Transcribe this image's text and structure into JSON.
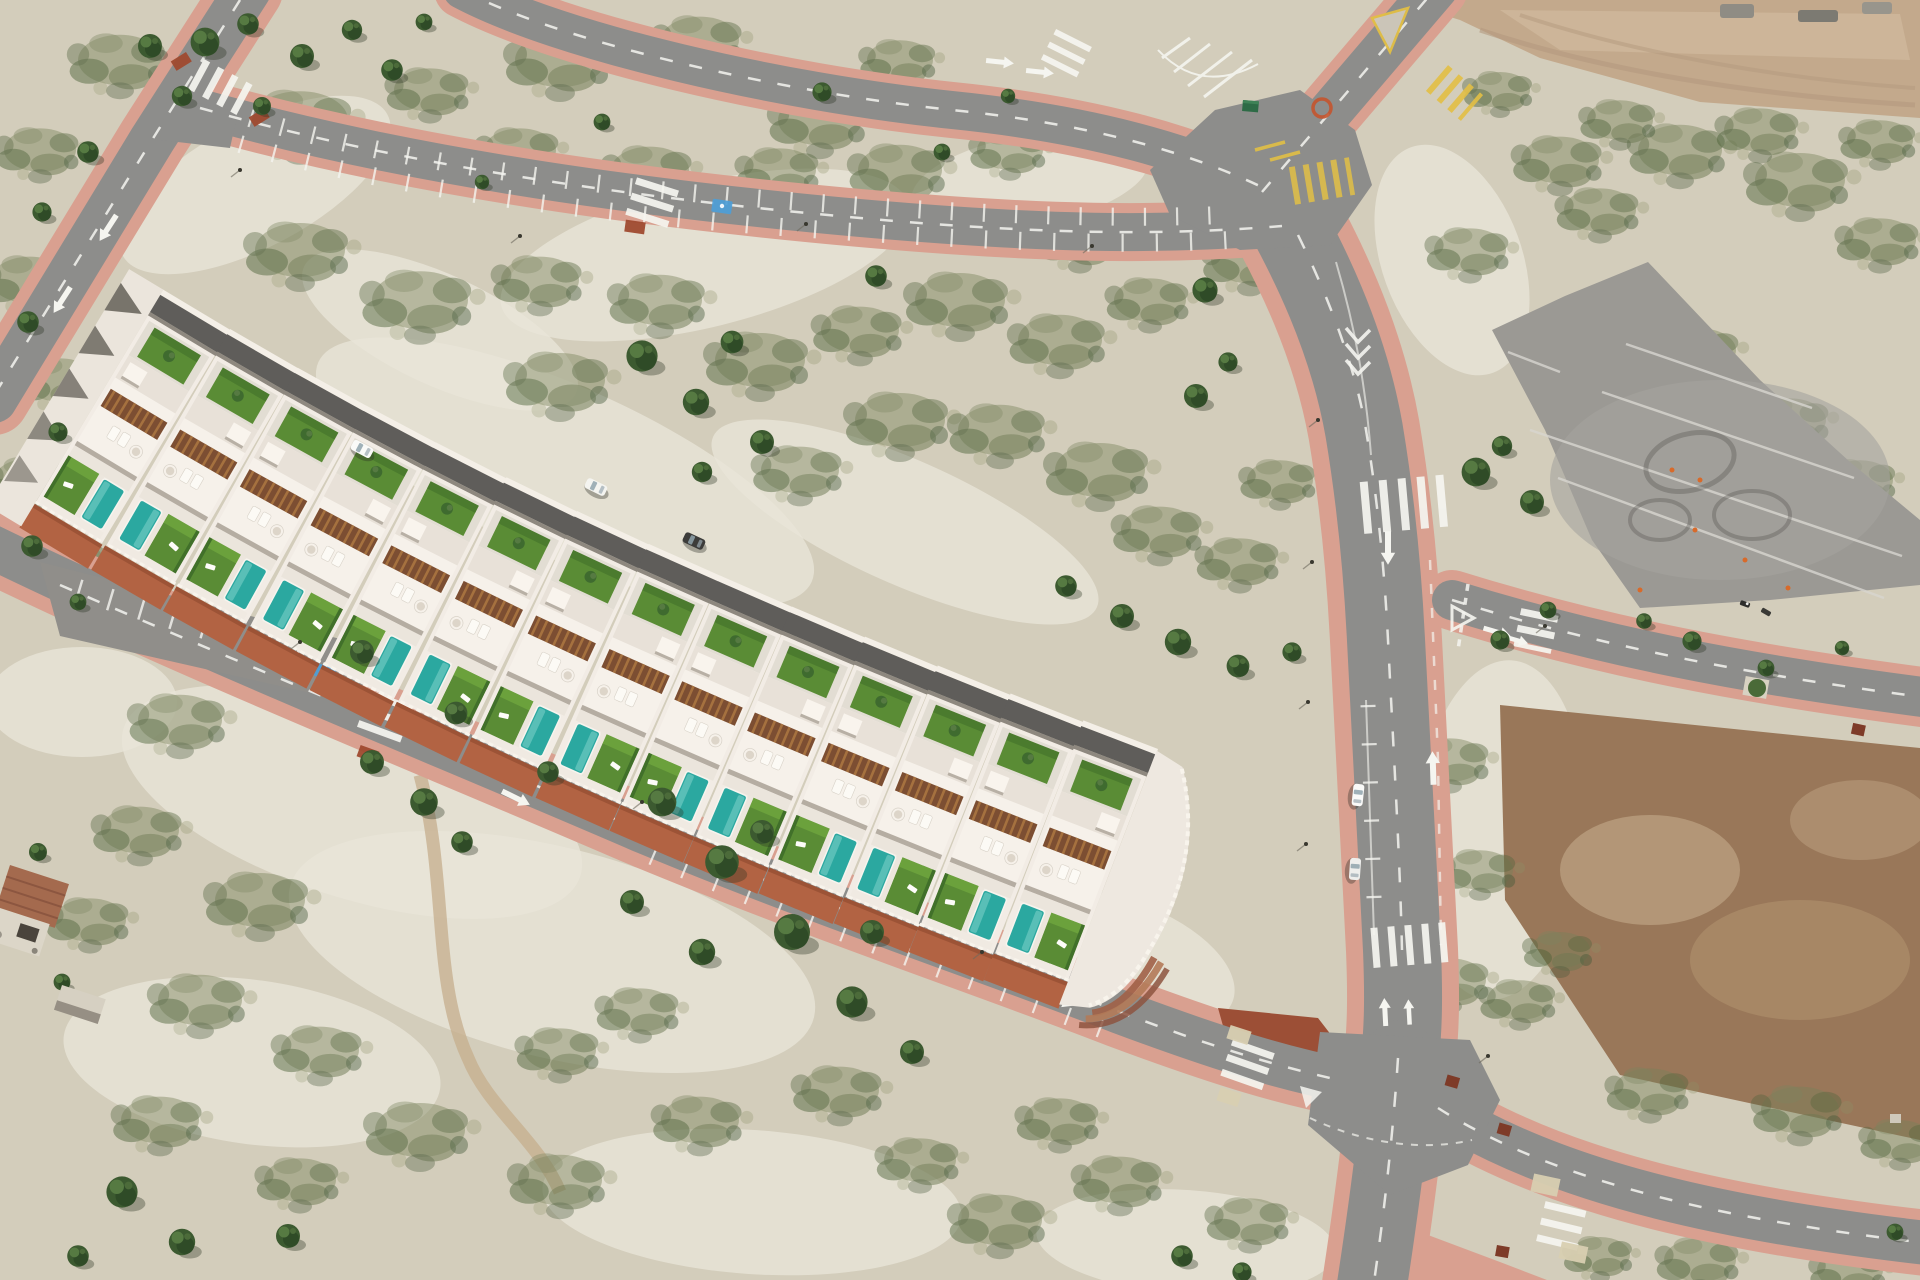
{
  "meta": {
    "type": "aerial-drone-photograph",
    "subject": "New-build terraced villa development with private pools beside an urbanised road network on semi-arid scrubland",
    "width_px": 1920,
    "height_px": 1280
  },
  "palette": {
    "ground_base": "#cfc9b4",
    "chalk": "#e9e5d8",
    "scrub_olive": "#77815a",
    "scrub_dark": "#4c6339",
    "pine_green": "#3c5a30",
    "asphalt": "#8d8d8b",
    "asphalt_light": "#9b9994",
    "sidewalk_pink": "#d9a090",
    "sidewalk_brick_red": "#b26343",
    "paver_dark_red": "#9c4f36",
    "dirt_tan": "#c3a98c",
    "dirt_brown": "#997759",
    "marking_white": "#f5f5f0",
    "marking_yellow": "#e2bf45",
    "villa_white": "#f2ece5",
    "pergola_brown": "#7c4e32",
    "lawn_green": "#5a8c35",
    "pool_turquoise": "#2ba8a0",
    "alley_asphalt": "#5f5d5a",
    "disabled_bay_blue": "#4d9fd8",
    "cone_orange": "#d86a2a",
    "terracotta_roof": "#a46a4e",
    "container_green": "#2e6b46"
  },
  "scene": {
    "development": {
      "name": "villa-row",
      "unit_count": 14,
      "unit_spacing_px": 78,
      "per_unit_features": [
        "rooftop solarium with sun loungers",
        "timber pergola",
        "rear patio lawn with palm",
        "front lawn",
        "private turquoise pool",
        "rear service alley access"
      ],
      "units": [
        [
          150,
          312,
          31
        ],
        [
          218,
          352,
          30
        ],
        [
          286,
          391,
          29
        ],
        [
          355,
          429,
          28
        ],
        [
          425,
          466,
          27
        ],
        [
          496,
          501,
          26
        ],
        [
          567,
          535,
          25
        ],
        [
          639,
          568,
          24
        ],
        [
          711,
          600,
          23.5
        ],
        [
          783,
          631,
          23
        ],
        [
          856,
          661,
          22.5
        ],
        [
          929,
          690,
          22
        ],
        [
          1002,
          718,
          21.5
        ],
        [
          1075,
          745,
          21
        ]
      ]
    },
    "vehicles": {
      "cars": [
        {
          "x": 1358,
          "y": 795,
          "rot": 96,
          "body": "#fafaf8",
          "note": "parked on main avenue"
        },
        {
          "x": 1355,
          "y": 869,
          "rot": 94,
          "body": "#eeeeec",
          "note": "parked on main avenue"
        },
        {
          "x": 362,
          "y": 449,
          "rot": 28,
          "body": "#fafaf8",
          "note": "rear alley of villas"
        },
        {
          "x": 596,
          "y": 487,
          "rot": 26,
          "body": "#f4f4f0",
          "note": "rear alley of villas"
        },
        {
          "x": 694,
          "y": 541,
          "rot": 25,
          "body": "#3c3c3a",
          "note": "dark SUV in rear alley"
        }
      ],
      "motorbikes": [
        {
          "x": 1745,
          "y": 604
        },
        {
          "x": 1766,
          "y": 612
        }
      ]
    },
    "roads": [
      {
        "name": "top-left-avenue",
        "features": [
          "zebra crossing",
          "lane arrows",
          "pink sidewalks"
        ]
      },
      {
        "name": "parking-street",
        "features": [
          "marked parking bays both sides",
          "zebra crossing",
          "blue disabled bay",
          "red paved bulb"
        ]
      },
      {
        "name": "upper-connector",
        "features": [
          "zebra crossing",
          "white chevron island",
          "direction arrows"
        ]
      },
      {
        "name": "north-exit",
        "features": [
          "yellow temporary markings",
          "splitter island",
          "yellow zebra"
        ]
      },
      {
        "name": "main-avenue",
        "features": [
          "two zebra crossings",
          "down and up lane arrows",
          "merge chevrons",
          "dashed lane lines",
          "parking ticks",
          "two parked cars"
        ]
      },
      {
        "name": "east-branch",
        "features": [
          "give-way triangle",
          "turn arrows",
          "zebra crossing",
          "stop dashes",
          "tree pit"
        ]
      },
      {
        "name": "villa-street",
        "features": [
          "parking apron with bays",
          "blue disabled bay",
          "zebra crossing",
          "direction arrows",
          "brick-red upper sidewalk"
        ]
      },
      {
        "name": "southeast-road",
        "features": [
          "zebra crossing",
          "tactile paving pads",
          "dashed centre line",
          "dark-red tree pits"
        ]
      }
    ],
    "terrain": {
      "dirt_lot_top_right": "graded bare earth with spoil heaps",
      "dirt_lot_mid_right": "brown cleared building plot",
      "practice_area": "asphalt pad with painted guide lines, circular skid marks, traffic cones and two motorbikes",
      "chalk": [
        [
          255,
          185,
          150,
          62,
          -28
        ],
        [
          705,
          255,
          210,
          72,
          -14
        ],
        [
          565,
          472,
          270,
          85,
          24
        ],
        [
          905,
          522,
          210,
          62,
          24
        ],
        [
          352,
          802,
          240,
          95,
          18
        ],
        [
          552,
          952,
          270,
          105,
          14
        ],
        [
          252,
          1062,
          190,
          82,
          8
        ],
        [
          752,
          1202,
          210,
          72,
          4
        ],
        [
          1500,
          830,
          85,
          170,
          4
        ],
        [
          1186,
          1242,
          150,
          52,
          4
        ],
        [
          82,
          702,
          95,
          55,
          0
        ],
        [
          1452,
          260,
          70,
          120,
          -20
        ],
        [
          1030,
          180,
          120,
          45,
          -10
        ],
        [
          440,
          330,
          150,
          55,
          25
        ],
        [
          1120,
          960,
          120,
          60,
          20
        ]
      ]
    },
    "vegetation": {
      "pines": [
        [
          205,
          42,
          1.2
        ],
        [
          248,
          24,
          0.9
        ],
        [
          302,
          56,
          1.0
        ],
        [
          352,
          30,
          0.85
        ],
        [
          392,
          70,
          0.9
        ],
        [
          424,
          22,
          0.7
        ],
        [
          182,
          96,
          0.85
        ],
        [
          262,
          106,
          0.75
        ],
        [
          88,
          152,
          0.9
        ],
        [
          42,
          212,
          0.8
        ],
        [
          28,
          322,
          0.9
        ],
        [
          58,
          432,
          0.8
        ],
        [
          32,
          546,
          0.9
        ],
        [
          78,
          602,
          0.7
        ],
        [
          150,
          46,
          1.0
        ],
        [
          642,
          356,
          1.3
        ],
        [
          696,
          402,
          1.1
        ],
        [
          732,
          342,
          0.95
        ],
        [
          762,
          442,
          1.0
        ],
        [
          702,
          472,
          0.85
        ],
        [
          876,
          276,
          0.9
        ],
        [
          942,
          152,
          0.7
        ],
        [
          822,
          92,
          0.8
        ],
        [
          602,
          122,
          0.7
        ],
        [
          482,
          182,
          0.6
        ],
        [
          1008,
          96,
          0.6
        ],
        [
          1066,
          586,
          0.9
        ],
        [
          1122,
          616,
          1.0
        ],
        [
          1178,
          642,
          1.1
        ],
        [
          1238,
          666,
          0.95
        ],
        [
          1292,
          652,
          0.8
        ],
        [
          1196,
          396,
          1.0
        ],
        [
          1228,
          362,
          0.8
        ],
        [
          1205,
          290,
          1.05
        ],
        [
          1476,
          472,
          1.2
        ],
        [
          1532,
          502,
          1.0
        ],
        [
          1502,
          446,
          0.85
        ],
        [
          1692,
          641,
          0.8
        ],
        [
          1766,
          668,
          0.7
        ],
        [
          1644,
          621,
          0.65
        ],
        [
          1842,
          648,
          0.6
        ],
        [
          122,
          1192,
          1.3
        ],
        [
          182,
          1242,
          1.1
        ],
        [
          78,
          1256,
          0.9
        ],
        [
          288,
          1236,
          1.0
        ],
        [
          62,
          982,
          0.7
        ],
        [
          38,
          852,
          0.75
        ],
        [
          662,
          802,
          1.2
        ],
        [
          722,
          862,
          1.4
        ],
        [
          792,
          932,
          1.5
        ],
        [
          852,
          1002,
          1.3
        ],
        [
          702,
          952,
          1.1
        ],
        [
          632,
          902,
          1.0
        ],
        [
          762,
          832,
          1.0
        ],
        [
          872,
          932,
          1.0
        ],
        [
          424,
          802,
          1.15
        ],
        [
          372,
          762,
          1.0
        ],
        [
          462,
          842,
          0.9
        ],
        [
          912,
          1052,
          1.0
        ],
        [
          362,
          652,
          1.0
        ],
        [
          456,
          713,
          0.95
        ],
        [
          548,
          772,
          0.9
        ],
        [
          1182,
          1256,
          0.9
        ],
        [
          1242,
          1272,
          0.8
        ],
        [
          1895,
          1232,
          0.7
        ],
        [
          1500,
          640,
          0.8
        ],
        [
          1548,
          610,
          0.7
        ]
      ],
      "scrub": [
        [
          120,
          60,
          1.4
        ],
        [
          300,
          120,
          1.6
        ],
        [
          430,
          90,
          1.2
        ],
        [
          560,
          60,
          1.5
        ],
        [
          700,
          40,
          1.3
        ],
        [
          820,
          120,
          1.4
        ],
        [
          900,
          60,
          1.1
        ],
        [
          520,
          150,
          1.2
        ],
        [
          650,
          170,
          1.3
        ],
        [
          780,
          170,
          1.2
        ],
        [
          900,
          170,
          1.4
        ],
        [
          1010,
          150,
          1.1
        ],
        [
          40,
          150,
          1.2
        ],
        [
          30,
          280,
          1.3
        ],
        [
          60,
          380,
          1.2
        ],
        [
          30,
          480,
          1.2
        ],
        [
          70,
          560,
          1.1
        ],
        [
          300,
          250,
          1.5
        ],
        [
          420,
          300,
          1.6
        ],
        [
          540,
          280,
          1.3
        ],
        [
          560,
          380,
          1.5
        ],
        [
          660,
          300,
          1.4
        ],
        [
          760,
          360,
          1.5
        ],
        [
          860,
          330,
          1.3
        ],
        [
          960,
          300,
          1.5
        ],
        [
          1060,
          340,
          1.4
        ],
        [
          900,
          420,
          1.5
        ],
        [
          800,
          470,
          1.3
        ],
        [
          1000,
          430,
          1.4
        ],
        [
          1100,
          470,
          1.5
        ],
        [
          1160,
          530,
          1.3
        ],
        [
          1240,
          560,
          1.2
        ],
        [
          1280,
          480,
          1.1
        ],
        [
          1150,
          300,
          1.2
        ],
        [
          1250,
          260,
          1.3
        ],
        [
          1080,
          240,
          1.2
        ],
        [
          1470,
          250,
          1.2
        ],
        [
          1560,
          160,
          1.3
        ],
        [
          1680,
          150,
          1.4
        ],
        [
          1800,
          180,
          1.5
        ],
        [
          1880,
          240,
          1.2
        ],
        [
          1600,
          210,
          1.2
        ],
        [
          1790,
          420,
          1.2
        ],
        [
          1860,
          480,
          1.1
        ],
        [
          1700,
          350,
          1.2
        ],
        [
          1620,
          330,
          1.0
        ],
        [
          180,
          720,
          1.4
        ],
        [
          140,
          830,
          1.3
        ],
        [
          260,
          900,
          1.5
        ],
        [
          200,
          1000,
          1.4
        ],
        [
          320,
          1050,
          1.3
        ],
        [
          420,
          1130,
          1.5
        ],
        [
          560,
          1180,
          1.4
        ],
        [
          700,
          1120,
          1.3
        ],
        [
          560,
          1050,
          1.2
        ],
        [
          640,
          1010,
          1.2
        ],
        [
          300,
          1180,
          1.2
        ],
        [
          160,
          1120,
          1.3
        ],
        [
          90,
          920,
          1.2
        ],
        [
          840,
          1090,
          1.3
        ],
        [
          920,
          1160,
          1.2
        ],
        [
          1000,
          1220,
          1.4
        ],
        [
          1120,
          1180,
          1.3
        ],
        [
          1250,
          1220,
          1.2
        ],
        [
          1060,
          1120,
          1.2
        ],
        [
          1450,
          980,
          1.2
        ],
        [
          1480,
          870,
          1.1
        ],
        [
          1450,
          760,
          1.2
        ],
        [
          1520,
          1000,
          1.1
        ],
        [
          1650,
          1090,
          1.2
        ],
        [
          1800,
          1110,
          1.3
        ],
        [
          1900,
          1140,
          1.1
        ],
        [
          1560,
          950,
          1.0
        ],
        [
          1700,
          1260,
          1.2
        ],
        [
          1850,
          1270,
          1.1
        ],
        [
          1600,
          1255,
          1.0
        ],
        [
          1500,
          90,
          1.0
        ],
        [
          1620,
          120,
          1.1
        ],
        [
          1760,
          130,
          1.2
        ],
        [
          1880,
          140,
          1.1
        ]
      ]
    },
    "landmarks": {
      "ruin": "derelict farmhouse with terracotta roof, bottom-left",
      "shed": "collapsed pale shed beside ruin",
      "container": "green site container near top junction",
      "rubble": "grey spoil heaps on graded lot, top-right"
    }
  }
}
